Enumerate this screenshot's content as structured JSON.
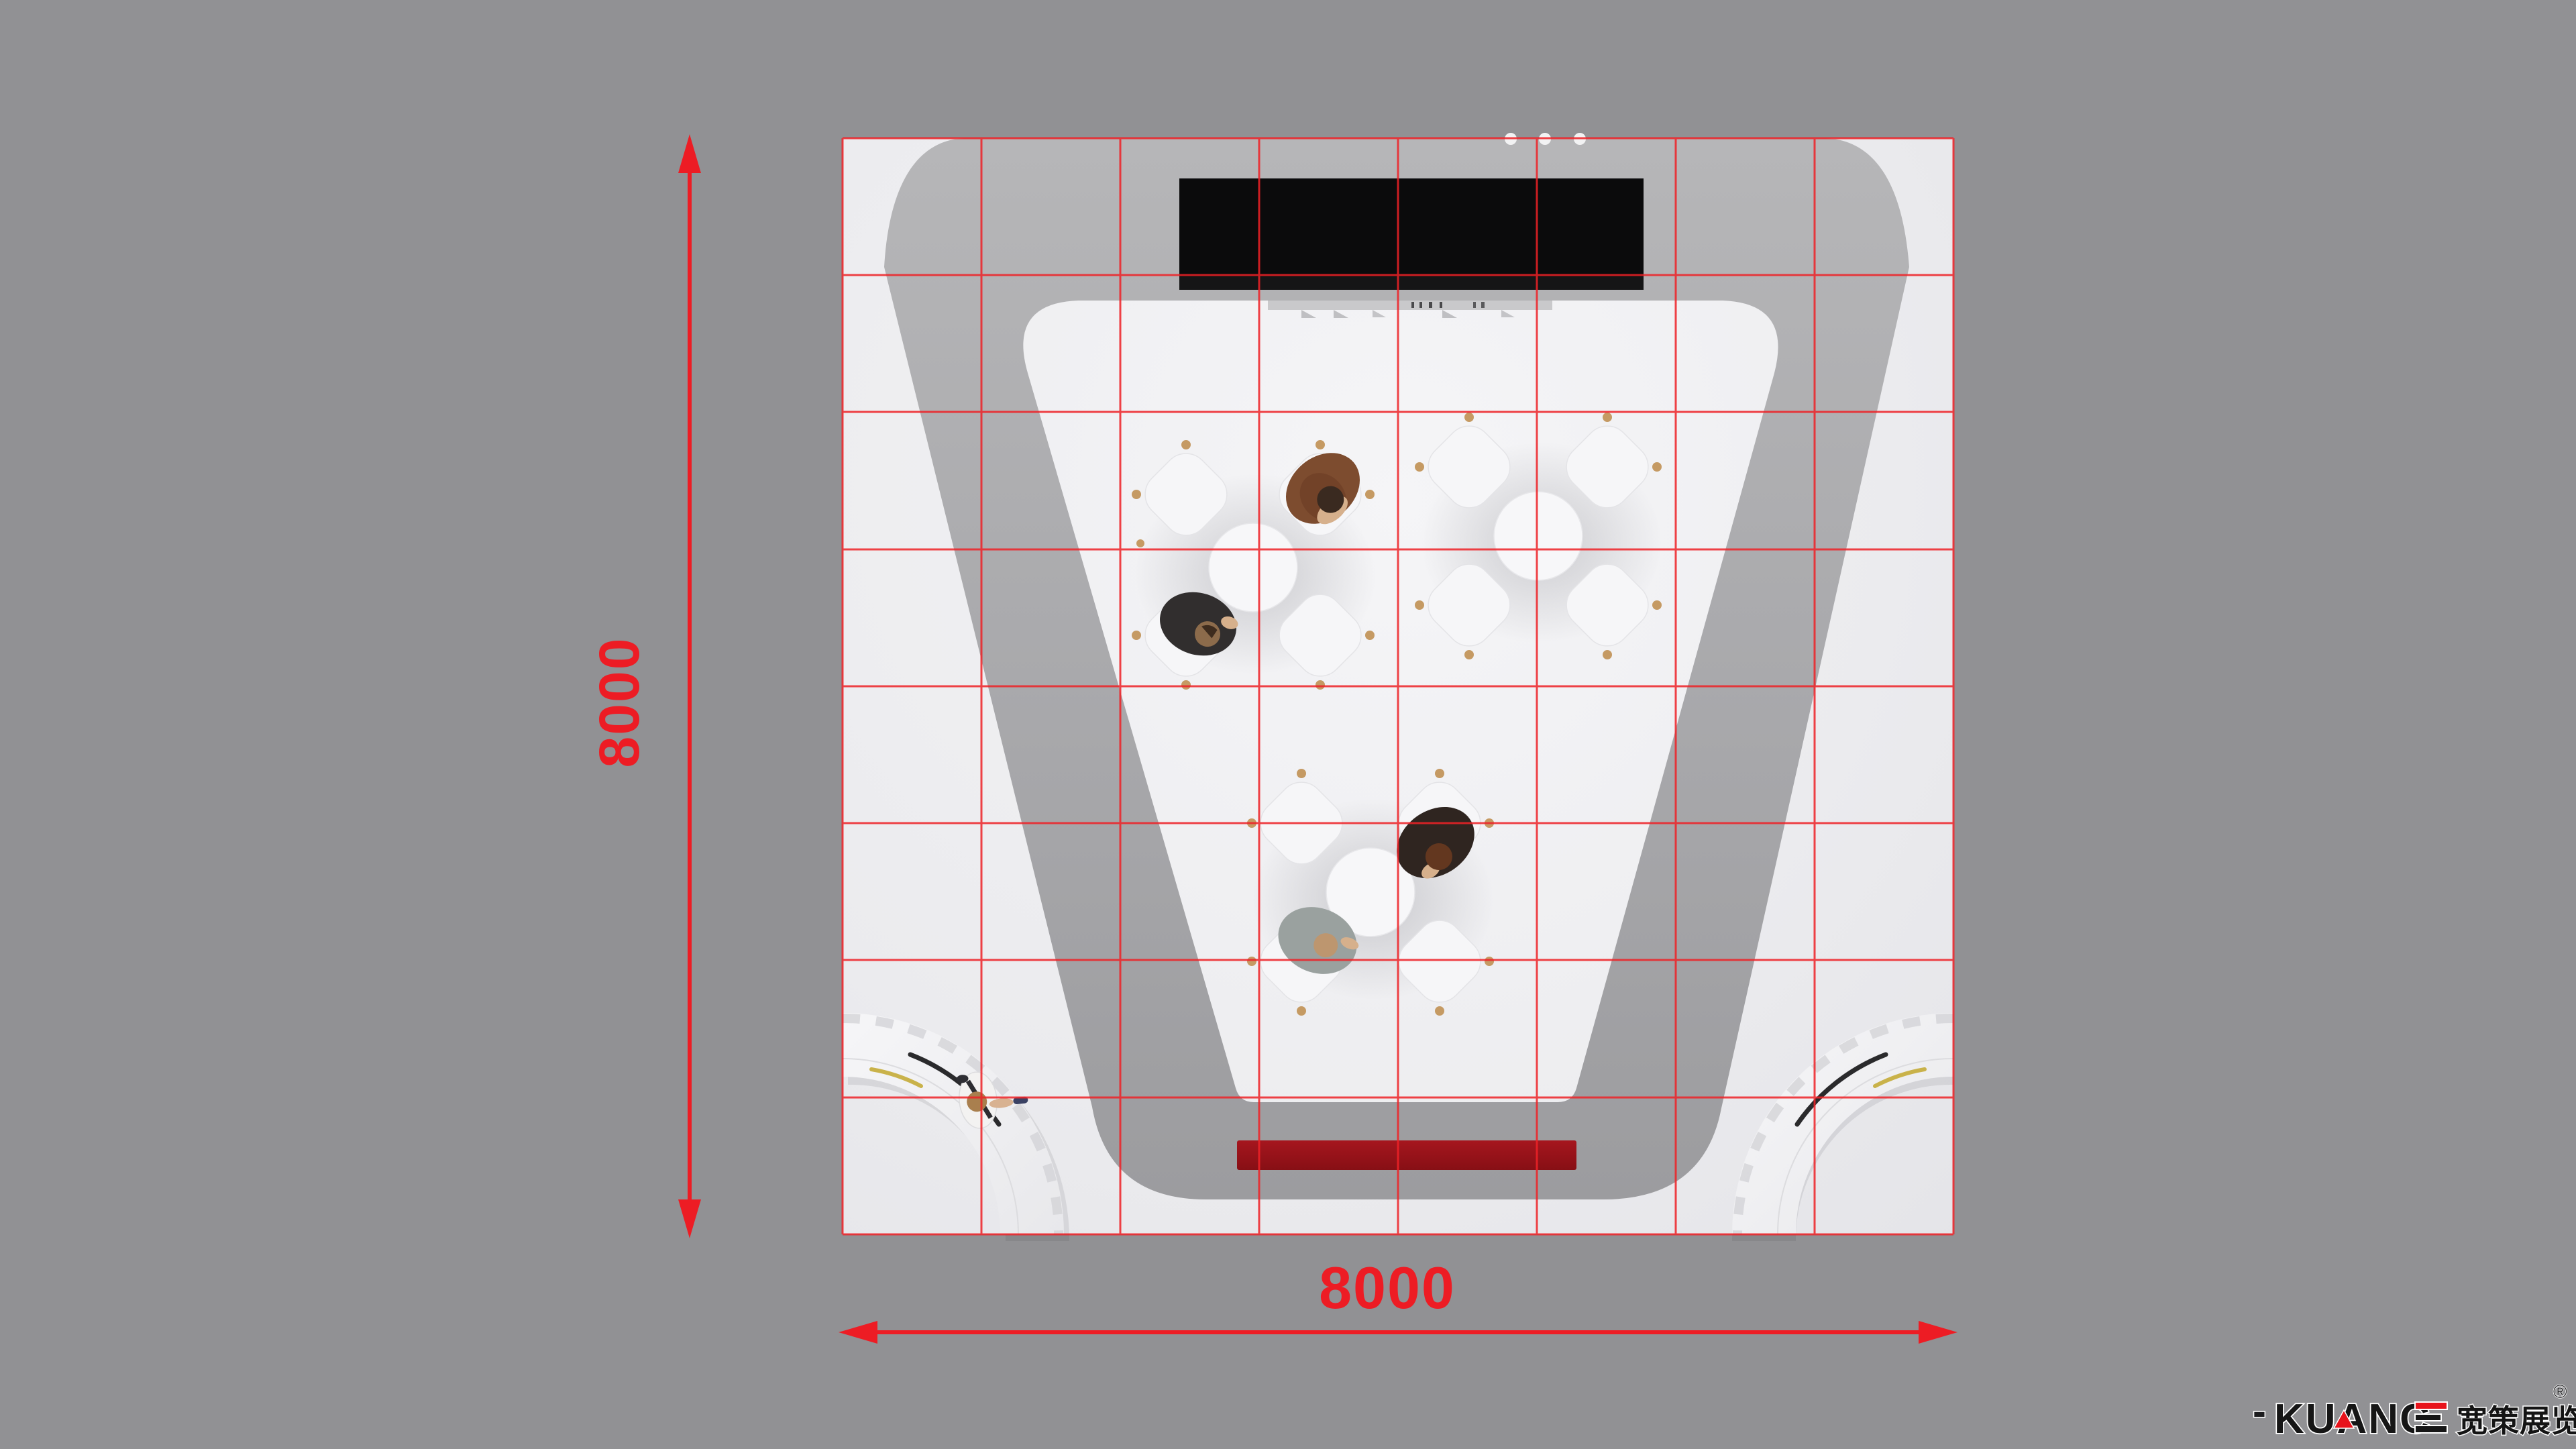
{
  "dimensions": {
    "width_label": "8000",
    "height_label": "8000",
    "accent_color": "#ed1c24"
  },
  "grid": {
    "rows": 8,
    "cols": 8,
    "line_color": "#ee2227"
  },
  "logo": {
    "dash": "-",
    "brand_latin": "KUANCE",
    "brand_latin_no_e": "KUANC",
    "brand_cjk": "宽策展览",
    "registered": "®"
  },
  "palette": {
    "background": "#919194",
    "floor": "#ebebee",
    "inner_floor": "#f2f2f5",
    "wall": "#abaaad",
    "screen": "#0b0b0c",
    "red_strip": "#97121a",
    "chair_leg": "#c59a63",
    "desk_accent_black": "#2a2a2c",
    "desk_accent_gold": "#c9b24a"
  }
}
